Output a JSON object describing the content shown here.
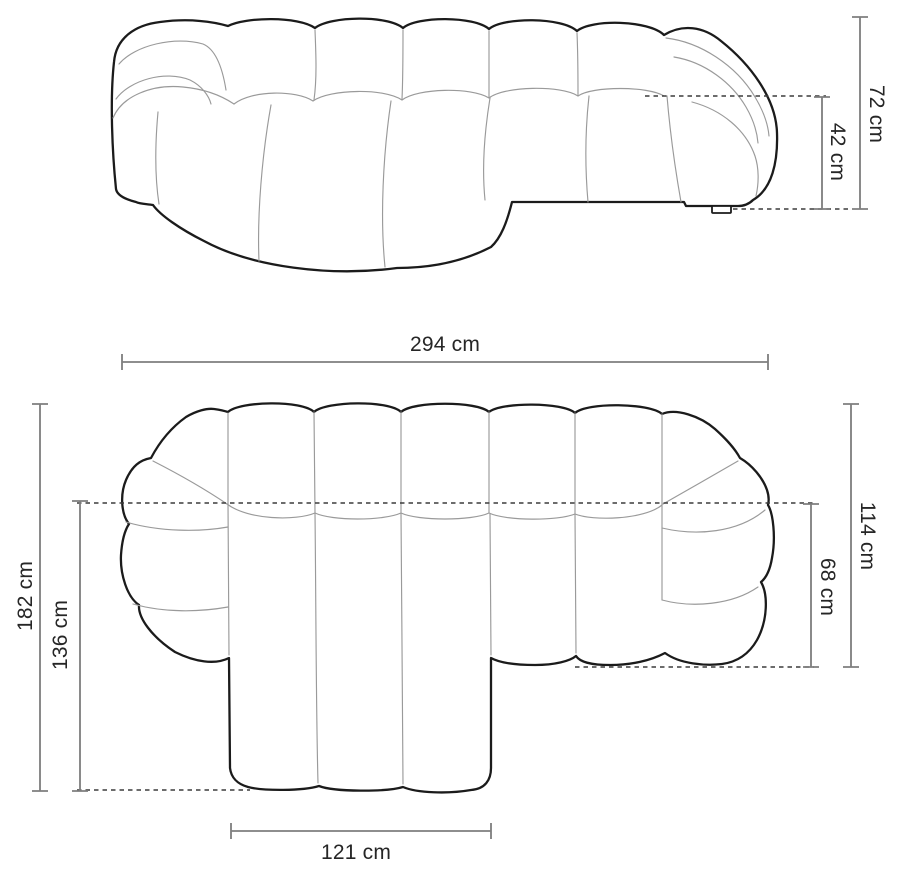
{
  "diagram_type": "sofa-dimension-drawing",
  "unit": "cm",
  "colors": {
    "background": "#ffffff",
    "outline": "#1b1b1b",
    "seam": "#9a9a9a",
    "dimension_line": "#7e7e7e",
    "dashed_line": "#3c3c3c",
    "label_text": "#262626"
  },
  "views": {
    "side_elevation": {
      "name": "side-elevation-view",
      "dimensions": [
        {
          "id": "overall_height",
          "label": "72 cm",
          "value": 72
        },
        {
          "id": "seat_height",
          "label": "42 cm",
          "value": 42
        }
      ]
    },
    "top_plan": {
      "name": "top-plan-view",
      "dimensions": [
        {
          "id": "overall_width",
          "label": "294 cm",
          "value": 294
        },
        {
          "id": "overall_depth",
          "label": "182 cm",
          "value": 182
        },
        {
          "id": "chaise_depth",
          "label": "136 cm",
          "value": 136
        },
        {
          "id": "right_side_depth",
          "label": "114 cm",
          "value": 114
        },
        {
          "id": "right_seat_depth",
          "label": "68 cm",
          "value": 68
        },
        {
          "id": "chaise_width",
          "label": "121 cm",
          "value": 121
        }
      ]
    }
  }
}
